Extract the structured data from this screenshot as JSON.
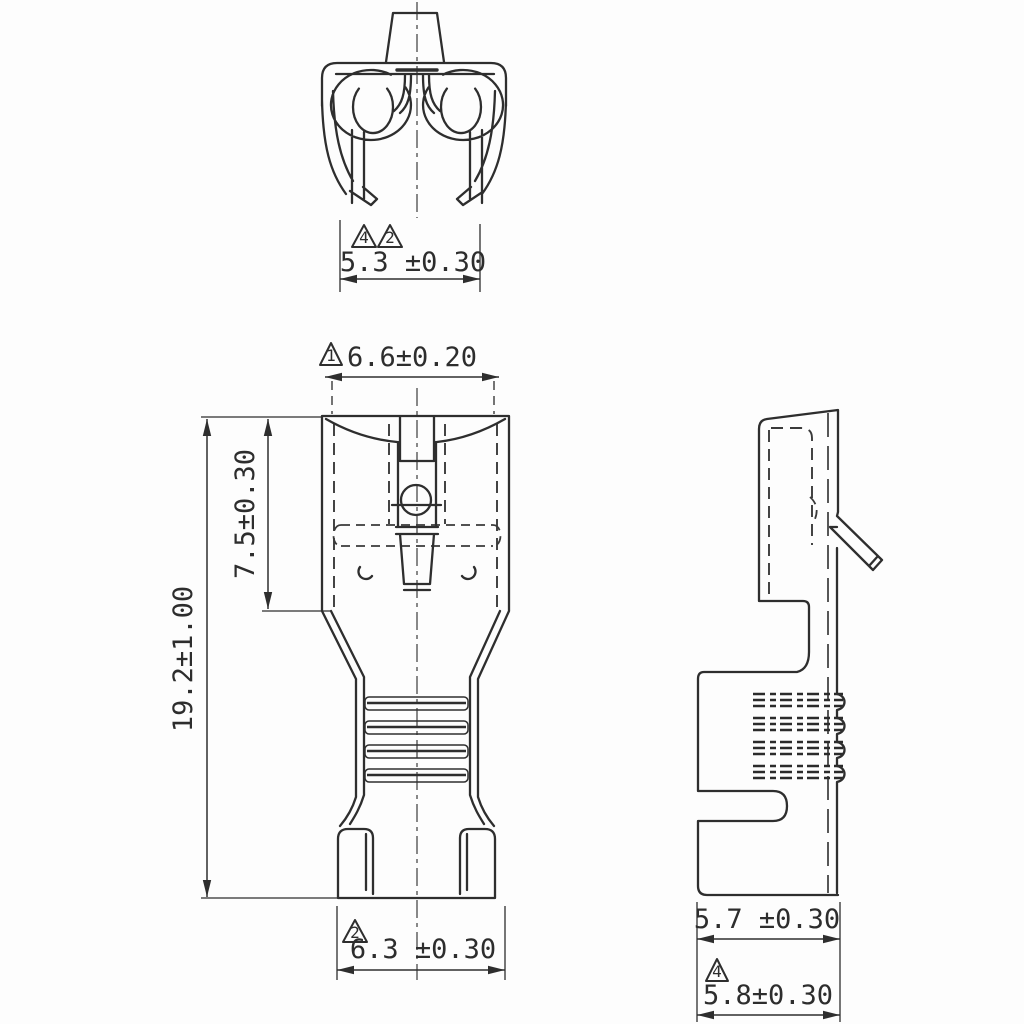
{
  "dimensions": {
    "end_view_width": "5.3 ±0.30",
    "receptacle_width": "6.6±0.20",
    "receptacle_length": "7.5±0.30",
    "overall_length": "19.2±1.00",
    "insulation_crimp_width": "6.3 ±0.30",
    "side_upper_depth": "5.7 ±0.30",
    "side_lower_depth": "5.8±0.30"
  },
  "note_flags": {
    "end_view_a": "4",
    "end_view_b": "2",
    "receptacle_width_flag": "1",
    "insulation_crimp_flag": "2",
    "side_lower_flag": "4"
  }
}
